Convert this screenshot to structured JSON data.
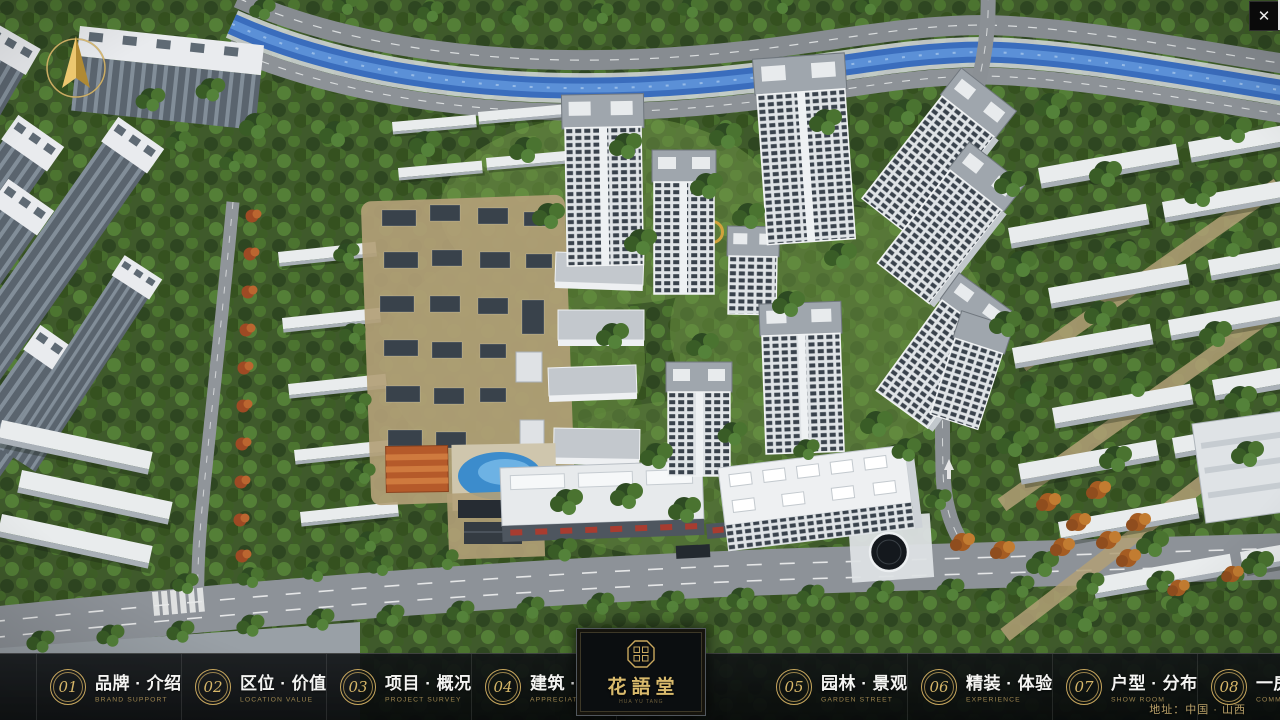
{
  "controls": {
    "close": "✕"
  },
  "icons": {
    "compass": "north-compass",
    "close": "close-x",
    "logo_seal": "octagon-seal"
  },
  "nav": {
    "items": [
      {
        "num": "01",
        "title": "品牌 · 介绍",
        "subtitle": "BRAND SUPPORT"
      },
      {
        "num": "02",
        "title": "区位 · 价值",
        "subtitle": "LOCATION VALUE"
      },
      {
        "num": "03",
        "title": "项目 · 概况",
        "subtitle": "PROJECT SURVEY"
      },
      {
        "num": "04",
        "title": "建筑 · 鉴赏",
        "subtitle": "APPRECIATION"
      },
      {
        "num": "05",
        "title": "园林 · 景观",
        "subtitle": "GARDEN STREET"
      },
      {
        "num": "06",
        "title": "精装 · 体验",
        "subtitle": "EXPERIENCE"
      },
      {
        "num": "07",
        "title": "户型 · 分布",
        "subtitle": "SHOW ROOM"
      },
      {
        "num": "08",
        "title": "一房 · 一景",
        "subtitle": "COMMUNITY"
      }
    ]
  },
  "logo": {
    "name": "花語堂",
    "tagline": "HUA YU TANG"
  },
  "footer": {
    "address": "地址：中国 · 山西"
  },
  "colors": {
    "accent_gold": "#c9a85e",
    "bar_background": "#0c0f11",
    "title_text": "#f4f4f2",
    "subtitle_text": "#9d8550",
    "river_blue": "#3a6dbd",
    "foliage_green": "#3f5a2b",
    "road_grey": "#8d9298",
    "building_white": "#eef0f2"
  }
}
